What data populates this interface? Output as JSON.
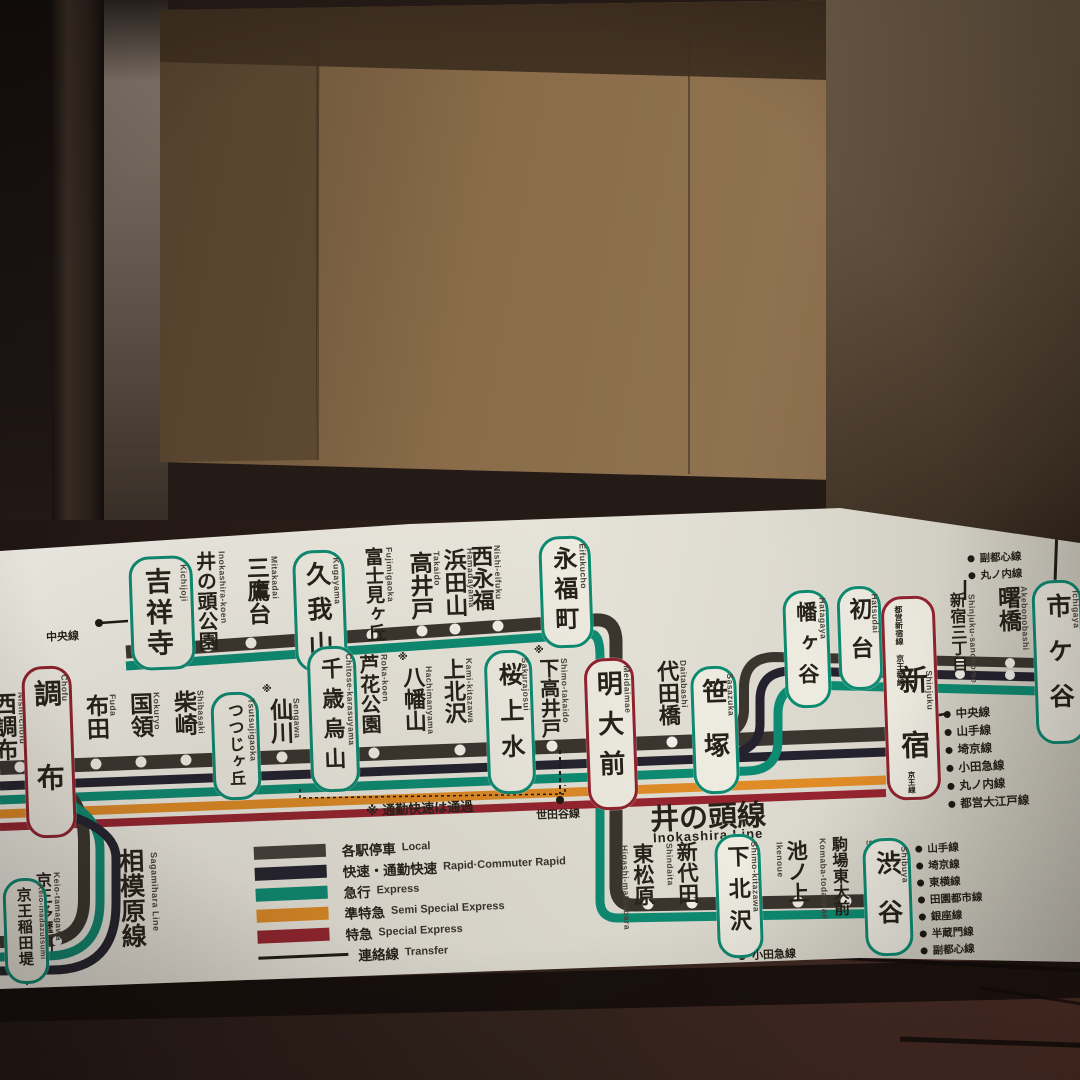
{
  "colors": {
    "local": "#45403a",
    "rapid": "#23222e",
    "express": "#0d8b72",
    "semi_special_express": "#df8b26",
    "special_express": "#96242f",
    "board": "#e9e6dc",
    "box_teal": "#0e8a71",
    "box_crimson": "#8f232d"
  },
  "headings": {
    "inokashira_jp": "井の頭線",
    "inokashira_en": "Inokashira Line",
    "sagamihara_jp": "相模原線",
    "sagamihara_en": "Sagamihara Line"
  },
  "note_rapid_pass": "※ 通勤快速は通過",
  "marks": {
    "pass": "※"
  },
  "legend": {
    "items": [
      {
        "jp": "各駅停車",
        "en": "Local"
      },
      {
        "jp": "快速・通勤快速",
        "en": "Rapid·Commuter Rapid"
      },
      {
        "jp": "急行",
        "en": "Express"
      },
      {
        "jp": "準特急",
        "en": "Semi Special Express"
      },
      {
        "jp": "特急",
        "en": "Special Express"
      },
      {
        "jp": "連絡線",
        "en": "Transfer"
      }
    ]
  },
  "stations": {
    "top": [
      {
        "name": "吉祥寺",
        "romaji": "Kichijoji",
        "box": "teal"
      },
      {
        "name": "井の頭公園",
        "romaji": "Inokashira-koen"
      },
      {
        "name": "三鷹台",
        "romaji": "Mitakadai"
      },
      {
        "name": "久我山",
        "romaji": "Kugayama",
        "box": "teal"
      },
      {
        "name": "富士見ヶ丘",
        "romaji": "Fujimigaoka"
      },
      {
        "name": "高井戸",
        "romaji": "Takaido"
      },
      {
        "name": "浜田山",
        "romaji": "Hamadayama"
      },
      {
        "name": "西永福",
        "romaji": "Nishi-eifuku"
      },
      {
        "name": "永福町",
        "romaji": "Eifukucho",
        "box": "teal"
      }
    ],
    "main": [
      {
        "name": "西調布",
        "romaji": "Nishi-chofu"
      },
      {
        "name": "調布",
        "romaji": "Chofu",
        "box": "crimson"
      },
      {
        "name": "布田",
        "romaji": "Fuda"
      },
      {
        "name": "国領",
        "romaji": "Kokuryo"
      },
      {
        "name": "柴崎",
        "romaji": "Shibasaki"
      },
      {
        "name": "つつじヶ丘",
        "romaji": "Tsutsujigaoka",
        "box": "teal"
      },
      {
        "name": "仙川",
        "romaji": "Sengawa",
        "mark": "※"
      },
      {
        "name": "千歳烏山",
        "romaji": "Chitose-karasuyama",
        "box": "teal"
      },
      {
        "name": "芦花公園",
        "romaji": "Roka-koen"
      },
      {
        "name": "八幡山",
        "romaji": "Hachimanyama",
        "mark": "※"
      },
      {
        "name": "上北沢",
        "romaji": "Kami-kitazawa"
      },
      {
        "name": "桜上水",
        "romaji": "Sakurajosui",
        "box": "teal"
      },
      {
        "name": "下高井戸",
        "romaji": "Shimo-takaido",
        "mark": "※"
      },
      {
        "name": "明大前",
        "romaji": "Meidaimae",
        "box": "crimson"
      },
      {
        "name": "代田橋",
        "romaji": "Daitabashi"
      },
      {
        "name": "笹塚",
        "romaji": "Sasazuka",
        "box": "teal"
      },
      {
        "name": "幡ヶ谷",
        "romaji": "Hatagaya",
        "box": "teal"
      },
      {
        "name": "初台",
        "romaji": "Hatsudai",
        "box": "teal"
      },
      {
        "name": "新宿",
        "romaji": "Shinjuku",
        "box": "crimson"
      }
    ],
    "upper": [
      {
        "name": "新宿三丁目",
        "romaji": "Shinjuku-sanchome"
      },
      {
        "name": "曙橋",
        "romaji": "Akebonobashi"
      },
      {
        "name": "市ケ谷",
        "romaji": "Ichigaya",
        "box": "teal"
      }
    ],
    "bottom": [
      {
        "name": "東松原",
        "romaji": "Higashi-matsubara"
      },
      {
        "name": "新代田",
        "romaji": "Shindaita"
      },
      {
        "name": "下北沢",
        "romaji": "Shimo-kitazawa",
        "box": "teal"
      },
      {
        "name": "池ノ上",
        "romaji": "Ikenoue"
      },
      {
        "name": "駒場東大前",
        "romaji": "Komaba-todaimae"
      },
      {
        "name": "神泉",
        "romaji": "Shinsen"
      },
      {
        "name": "渋谷",
        "romaji": "Shibuya",
        "box": "teal"
      }
    ],
    "sagamihara": [
      {
        "name": "京王多摩川",
        "romaji": "Keio-tamagawa"
      },
      {
        "name": "京王稲田堤",
        "romaji": "Keio-inadazutsumi",
        "box": "teal"
      }
    ]
  },
  "shinjuku_box": {
    "top_right": "都営新宿線",
    "top_left": "京王新線",
    "bottom": "京王線"
  },
  "transfers": {
    "kichijoji": "中央線",
    "shimotakaido": "世田谷線",
    "shimokitazawa": "小田急線",
    "inadazutsumi": "南武線",
    "shinjuku": [
      "中央線",
      "山手線",
      "埼京線",
      "小田急線",
      "丸ノ内線",
      "都営大江戸線"
    ],
    "shinjuku_sanchome": [
      "副都心線",
      "丸ノ内線"
    ],
    "shibuya": [
      "山手線",
      "埼京線",
      "東横線",
      "田園都市線",
      "銀座線",
      "半蔵門線",
      "副都心線"
    ]
  }
}
